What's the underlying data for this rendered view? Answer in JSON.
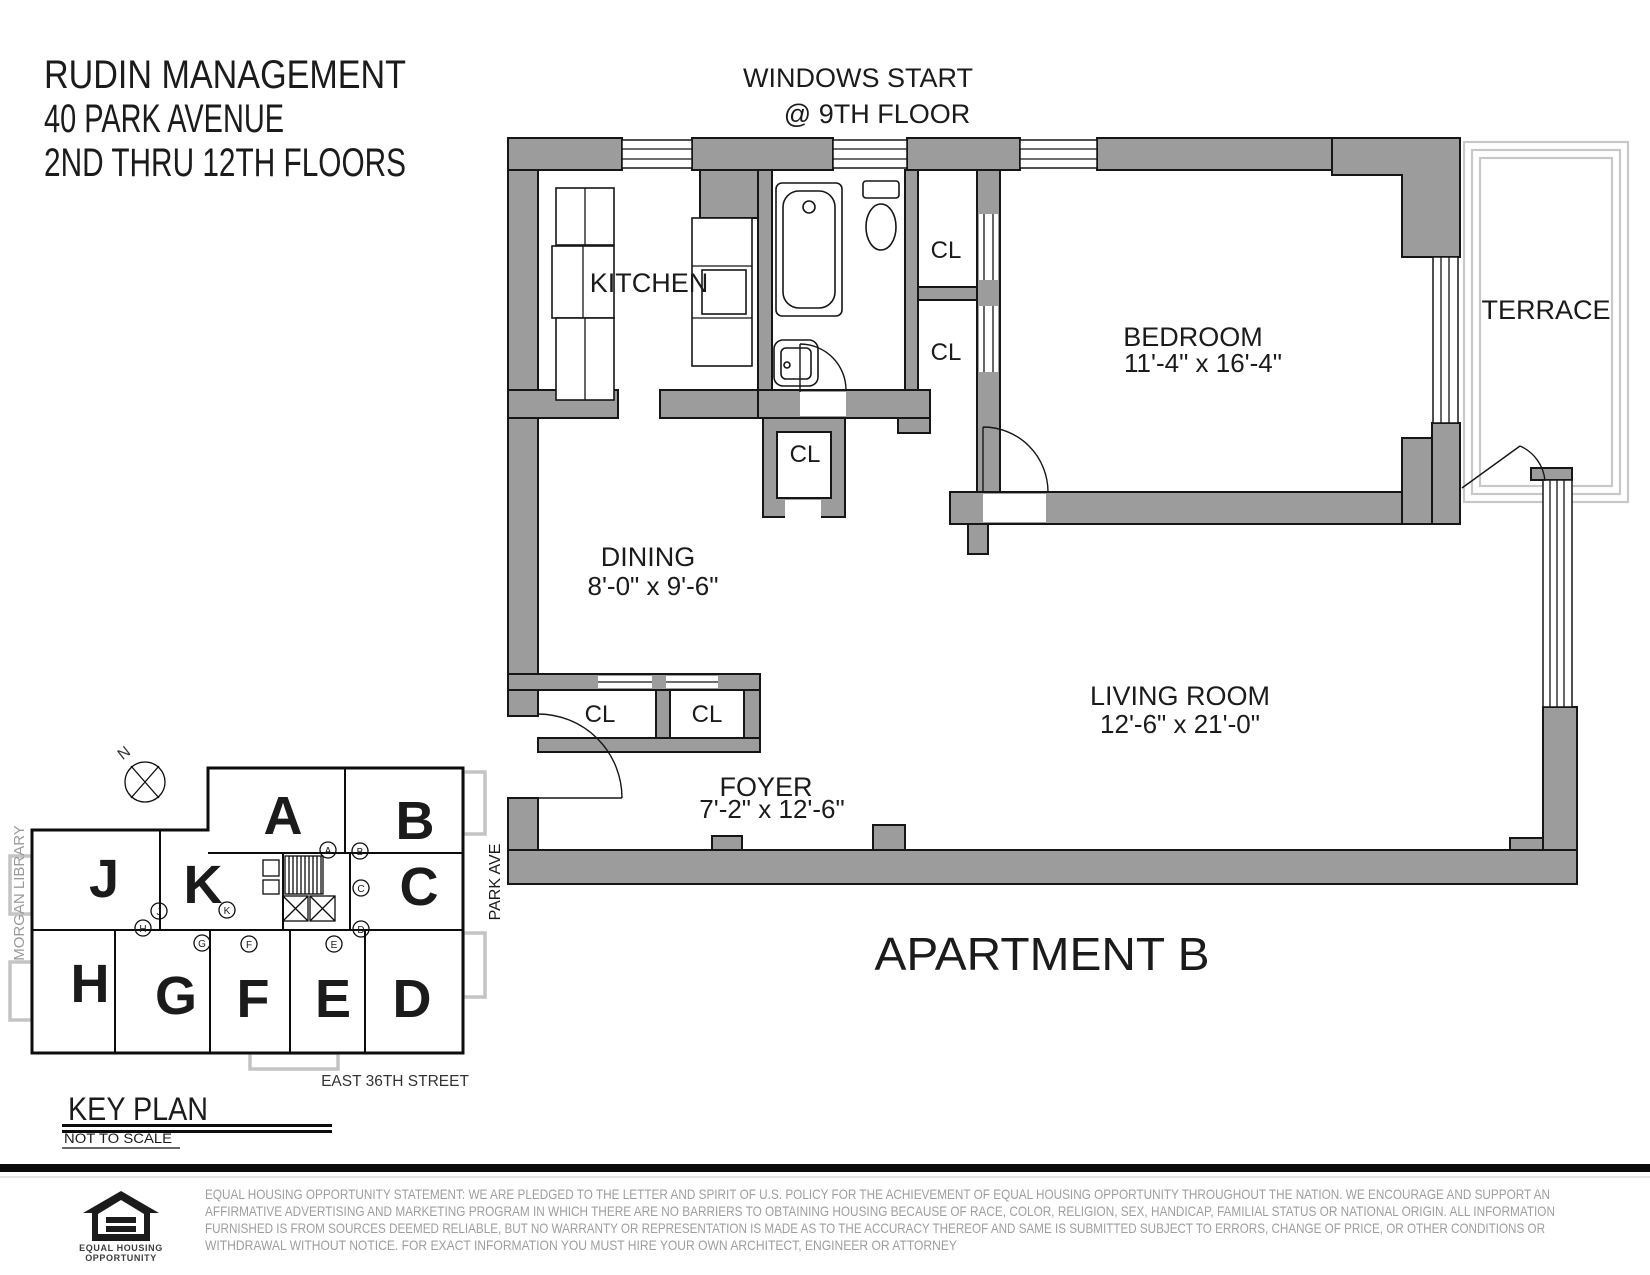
{
  "page": {
    "background": "#ffffff",
    "wall_color": "#9c9c9c",
    "line_color": "#161616",
    "terrace_line_color": "#c8c8c8"
  },
  "title_block": {
    "line1": "RUDIN MANAGEMENT",
    "line2": "40 PARK AVENUE",
    "line3": "2ND THRU 12TH FLOORS"
  },
  "window_note": {
    "line1": "WINDOWS START",
    "line2": "@ 9TH FLOOR"
  },
  "apartment": {
    "label": "APARTMENT B",
    "closet_label": "CL",
    "rooms": {
      "kitchen": {
        "name": "KITCHEN"
      },
      "bedroom": {
        "name": "BEDROOM",
        "dims": "11'-4\" x 16'-4\""
      },
      "terrace": {
        "name": "TERRACE"
      },
      "dining": {
        "name": "DINING",
        "dims": "8'-0\" x 9'-6\""
      },
      "living_room": {
        "name": "LIVING ROOM",
        "dims": "12'-6\" x 21'-0\""
      },
      "foyer": {
        "name": "FOYER",
        "dims": "7'-2\" x 12'-6\""
      }
    }
  },
  "key_plan": {
    "title": "KEY PLAN",
    "note": "NOT TO SCALE",
    "street_label": "EAST 36TH STREET",
    "avenue_label": "PARK AVE",
    "library_label": "MORGAN LIBRARY",
    "north_label": "N",
    "units": [
      "A",
      "B",
      "C",
      "D",
      "E",
      "F",
      "G",
      "H",
      "J",
      "K"
    ]
  },
  "footer": {
    "logo": {
      "icon": "equal-housing-house-icon",
      "line1": "EQUAL HOUSING",
      "line2": "OPPORTUNITY"
    },
    "statement": {
      "line1": "EQUAL HOUSING OPPORTUNITY STATEMENT: WE ARE PLEDGED TO THE LETTER AND SPIRIT OF U.S. POLICY FOR THE ACHIEVEMENT OF EQUAL HOUSING OPPORTUNITY THROUGHOUT THE NATION.  WE ENCOURAGE AND SUPPORT AN",
      "line2": "AFFIRMATIVE ADVERTISING AND MARKETING PROGRAM IN WHICH THERE ARE NO BARRIERS TO OBTAINING HOUSING BECAUSE OF RACE, COLOR, RELIGION, SEX, HANDICAP, FAMILIAL STATUS OR NATIONAL ORIGIN.  ALL INFORMATION",
      "line3": "FURNISHED IS FROM SOURCES DEEMED RELIABLE, BUT NO WARRANTY OR REPRESENTATION IS MADE AS TO THE ACCURACY THEREOF AND SAME IS SUBMITTED SUBJECT TO ERRORS, CHANGE OF PRICE, OR OTHER CONDITIONS OR",
      "line4": "WITHDRAWAL WITHOUT NOTICE.  FOR EXACT INFORMATION YOU MUST HIRE YOUR OWN ARCHITECT, ENGINEER OR ATTORNEY"
    }
  }
}
